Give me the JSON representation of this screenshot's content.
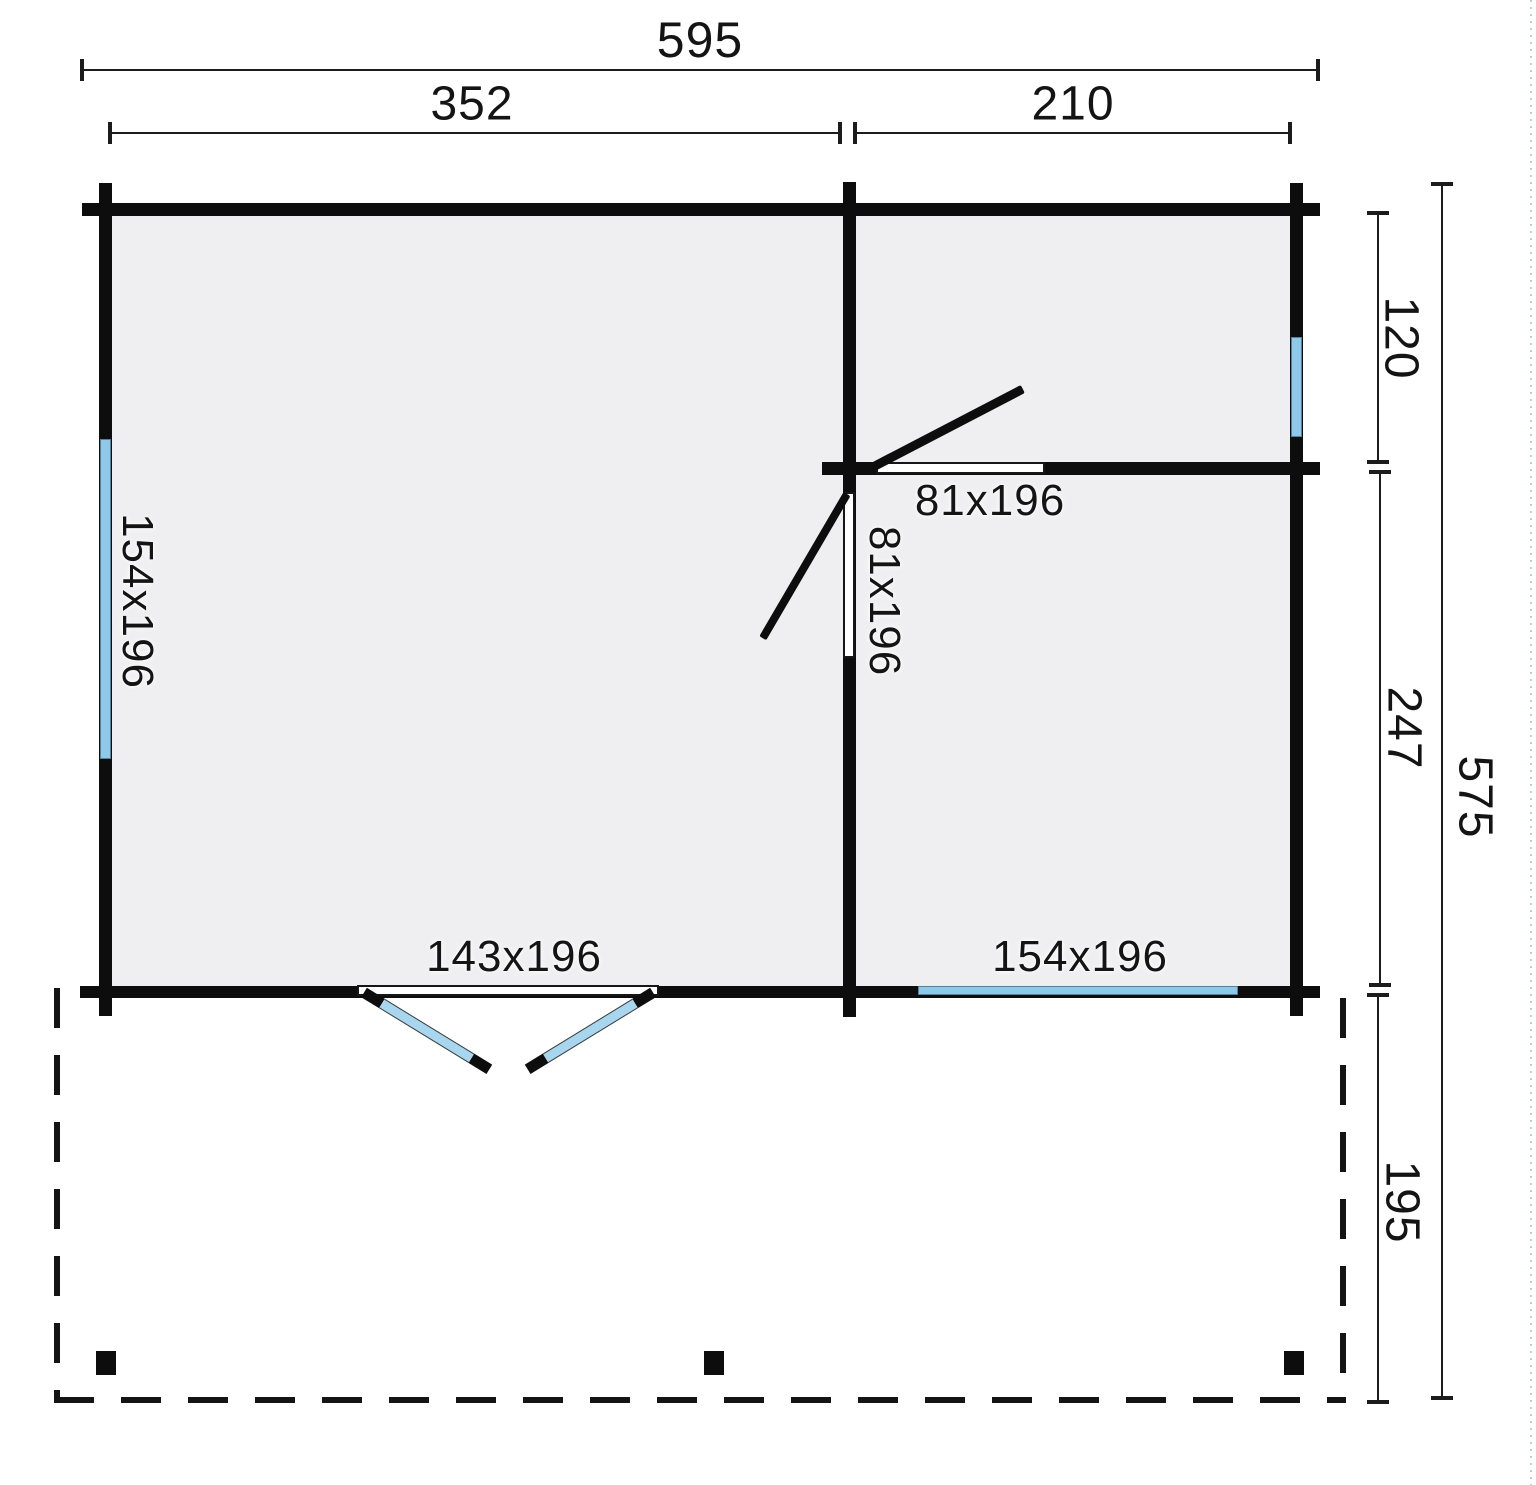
{
  "diagram_type": "floor-plan",
  "units_note": "cm",
  "colors": {
    "background": "#ffffff",
    "room_fill": "#efeff1",
    "wall": "#0d0d0d",
    "window_glazing": "#8ec9ea",
    "door_leaf_glazing": "#a9d6ef",
    "dimension_line": "#1c1c1c",
    "text": "#141414"
  },
  "dimensions": {
    "overall_width": "595",
    "left_room_width": "352",
    "right_room_width": "210",
    "right_top_room_depth": "120",
    "right_bottom_room_depth": "247",
    "terrace_depth": "195",
    "overall_depth": "575"
  },
  "openings": {
    "left_wall_window": "154x196",
    "rear_right_door": "81x196",
    "interior_door": "81x196",
    "front_double_door": "143x196",
    "front_window": "154x196"
  }
}
